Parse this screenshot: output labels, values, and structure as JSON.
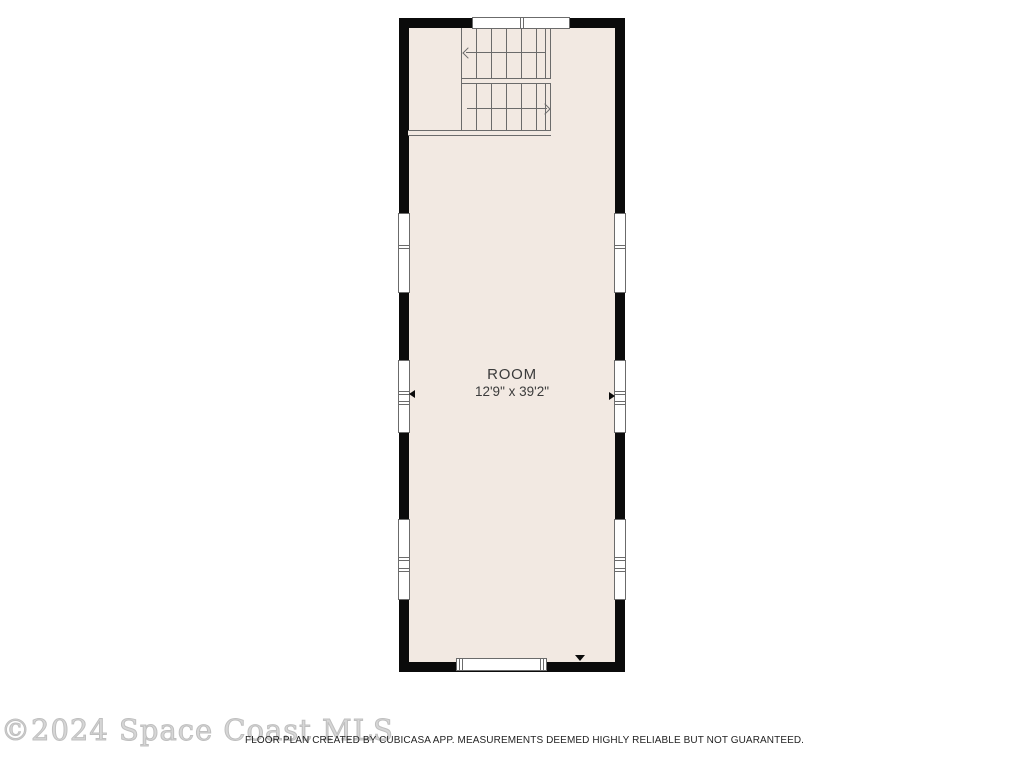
{
  "room": {
    "name": "ROOM",
    "dimensions": "12'9\" x 39'2\""
  },
  "footer": {
    "watermark": "©2024 Space Coast MLS",
    "disclaimer": "FLOOR PLAN CREATED BY CUBICASA APP. MEASUREMENTS DEEMED HIGHLY RELIABLE BUT NOT GUARANTEED."
  },
  "icons": {
    "stair_up_run": "stair-direction-arrow-left",
    "stair_down_run": "stair-direction-arrow-right",
    "dimension_markers": [
      "dimension-arrow-up",
      "dimension-arrow-down",
      "dimension-arrow-left",
      "dimension-arrow-right"
    ]
  },
  "colors": {
    "wall": "#0b0b0b",
    "floor": "#f2e9e2",
    "line": "#6b6b6b",
    "text": "#3b3b3b",
    "watermark": "#d6d6d6",
    "disclaimer": "#232323",
    "background": "#ffffff"
  }
}
